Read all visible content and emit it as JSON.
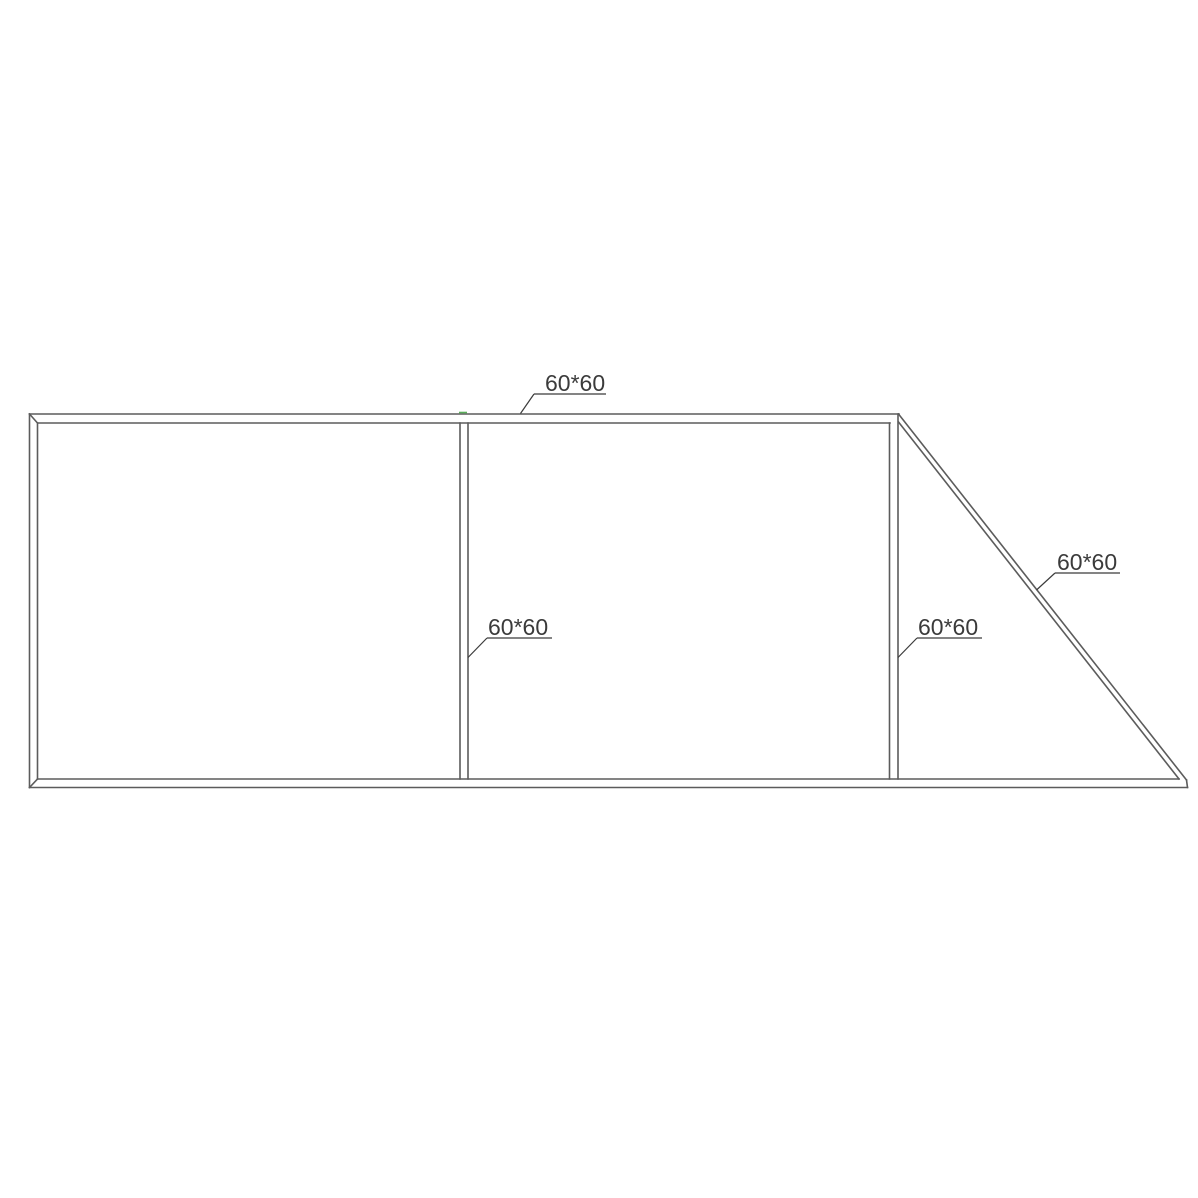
{
  "page": {
    "width": 1198,
    "height": 1198,
    "background": "#ffffff"
  },
  "drawing": {
    "type": "technical-line-drawing",
    "description": "Gate frame elevation with square tube members and dimension callouts",
    "line_color": "#5c5c5c",
    "line_width": 1.6,
    "label_color": "#3b3b3b",
    "label_font_size": 23,
    "leader_width": 1.2,
    "accent_tick_color": "#49a649",
    "members": [
      {
        "name": "top-rail-outer-edge",
        "x1": 29.5,
        "y1": 414,
        "x2": 899,
        "y2": 414
      },
      {
        "name": "top-rail-inner-edge",
        "x1": 38,
        "y1": 423,
        "x2": 890,
        "y2": 423
      },
      {
        "name": "left-stile-outer-edge",
        "x1": 29.5,
        "y1": 414,
        "x2": 29.5,
        "y2": 787.5
      },
      {
        "name": "left-stile-inner-edge",
        "x1": 37.5,
        "y1": 423,
        "x2": 37.5,
        "y2": 779
      },
      {
        "name": "top-left-miter-joint",
        "x1": 29.5,
        "y1": 414,
        "x2": 37.5,
        "y2": 423
      },
      {
        "name": "bottom-left-miter-joint",
        "x1": 29.5,
        "y1": 787.5,
        "x2": 37.5,
        "y2": 779
      },
      {
        "name": "bottom-rail-top-edge",
        "x1": 37.5,
        "y1": 779,
        "x2": 1179,
        "y2": 779
      },
      {
        "name": "bottom-rail-bottom-edge",
        "x1": 29.5,
        "y1": 787.5,
        "x2": 1187.5,
        "y2": 787.5
      },
      {
        "name": "bottom-rail-right-end-cap",
        "x1": 1186.5,
        "y1": 780,
        "x2": 1187.5,
        "y2": 787.5
      },
      {
        "name": "center-post-left-edge",
        "x1": 460,
        "y1": 423,
        "x2": 460,
        "y2": 779
      },
      {
        "name": "center-post-right-edge",
        "x1": 468,
        "y1": 423,
        "x2": 468,
        "y2": 779
      },
      {
        "name": "right-post-left-edge",
        "x1": 889.5,
        "y1": 423,
        "x2": 889.5,
        "y2": 779
      },
      {
        "name": "right-post-right-edge",
        "x1": 898,
        "y1": 414,
        "x2": 898,
        "y2": 779
      },
      {
        "name": "diagonal-brace-outer-edge",
        "x1": 898.5,
        "y1": 414,
        "x2": 1186.5,
        "y2": 780
      },
      {
        "name": "diagonal-brace-inner-edge",
        "x1": 898.5,
        "y1": 422,
        "x2": 1179,
        "y2": 779
      }
    ],
    "green_tick": {
      "x1": 459,
      "y1": 412.5,
      "x2": 467,
      "y2": 412.5
    },
    "labels": [
      {
        "name": "dimension-label-top-rail",
        "text": "60*60",
        "text_x": 545,
        "text_y": 391,
        "underline": [
          534,
          394,
          606,
          394
        ],
        "leader": [
          534,
          394,
          520.5,
          413.5
        ]
      },
      {
        "name": "dimension-label-center-post",
        "text": "60*60",
        "text_x": 488,
        "text_y": 635,
        "underline": [
          487,
          638,
          552,
          638
        ],
        "leader": [
          487,
          638,
          468,
          657.5
        ]
      },
      {
        "name": "dimension-label-right-post",
        "text": "60*60",
        "text_x": 918,
        "text_y": 635,
        "underline": [
          917,
          638,
          982,
          638
        ],
        "leader": [
          917,
          638,
          898,
          657.5
        ]
      },
      {
        "name": "dimension-label-diagonal-brace",
        "text": "60*60",
        "text_x": 1057,
        "text_y": 570,
        "underline": [
          1055,
          573,
          1120,
          573
        ],
        "leader": [
          1055,
          573,
          1036.5,
          590
        ]
      }
    ]
  }
}
